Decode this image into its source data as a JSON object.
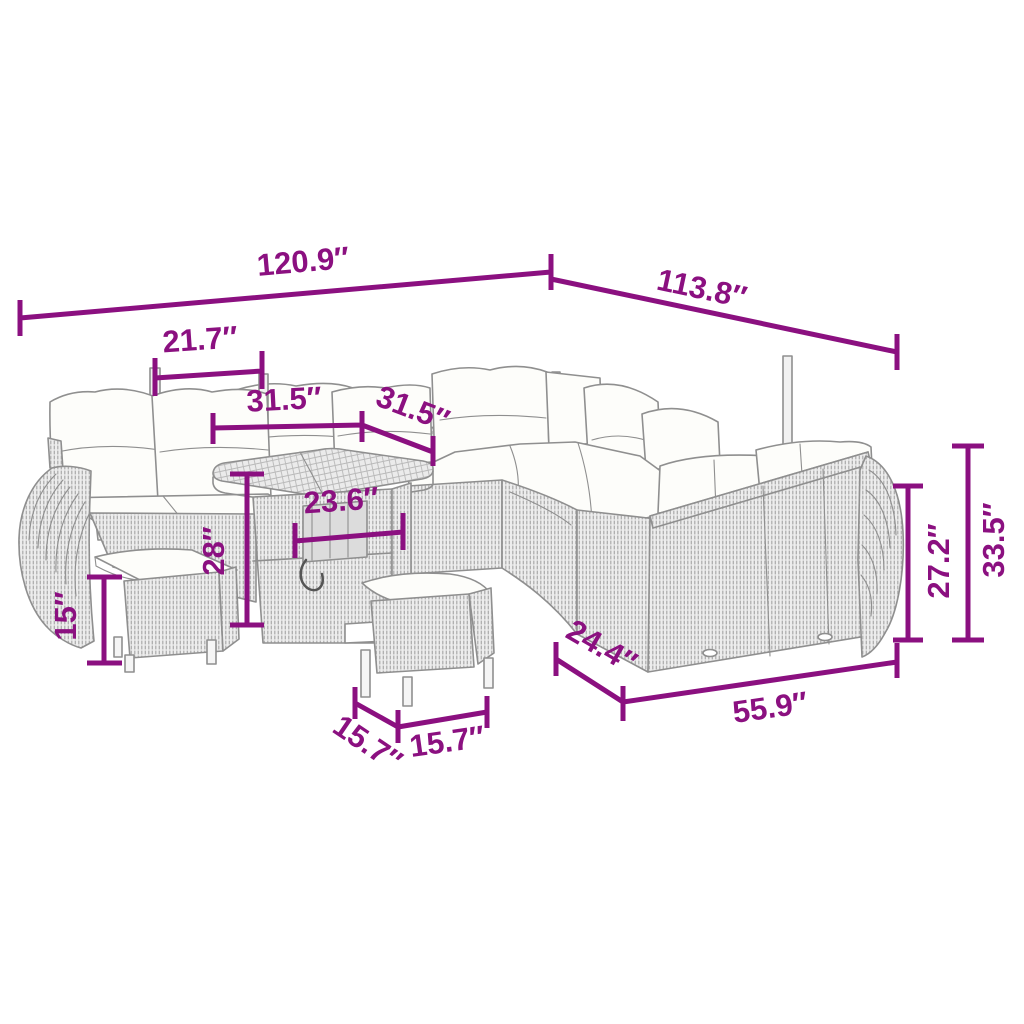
{
  "diagram": {
    "kind": "product-dimension-diagram",
    "subject": "rattan-garden-furniture-set",
    "unit": "inches",
    "colors": {
      "dimension": "#8B1080",
      "line_art": "#8f8f8f",
      "cushion": "#fdfdfa",
      "background": "#ffffff"
    },
    "dimensions": [
      {
        "id": "overall-width-left",
        "label": "120.9″"
      },
      {
        "id": "overall-width-right",
        "label": "113.8″"
      },
      {
        "id": "seat-width",
        "label": "21.7″"
      },
      {
        "id": "table-top-width",
        "label": "31.5″"
      },
      {
        "id": "table-top-depth",
        "label": "31.5″"
      },
      {
        "id": "table-inner-width",
        "label": "23.6″"
      },
      {
        "id": "table-height",
        "label": "28″"
      },
      {
        "id": "stool-height",
        "label": "15″"
      },
      {
        "id": "sofa-back-height",
        "label": "27.2″"
      },
      {
        "id": "sofa-total-height",
        "label": "33.5″"
      },
      {
        "id": "sofa-depth",
        "label": "24.4″"
      },
      {
        "id": "sofa-width",
        "label": "55.9″"
      },
      {
        "id": "stool-depth",
        "label": "15.7″"
      },
      {
        "id": "stool-width",
        "label": "15.7″"
      }
    ]
  }
}
